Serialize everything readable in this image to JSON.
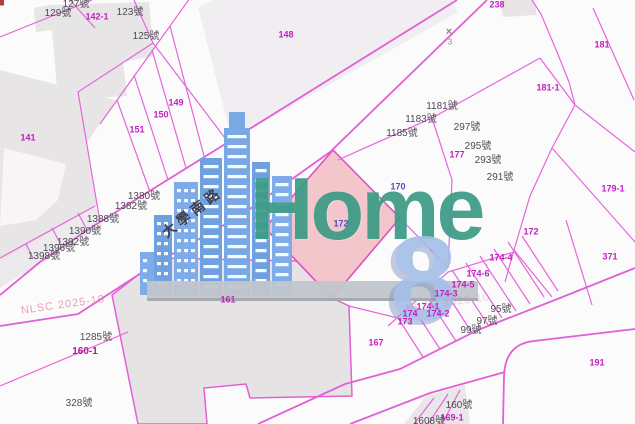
{
  "logo": {
    "wordmark": "Home",
    "number": "8"
  },
  "map": {
    "road_name": "大學南路",
    "watermark": "NLSC 2025-10",
    "control_point_number": "3",
    "control_point_symbol": "×",
    "selected_parcel": {
      "parcel_label": "172",
      "fill": "#f3c6cb"
    },
    "colors": {
      "boundary_line": "#e160d6",
      "parcel_label": "#c21ec2",
      "address_label": "#4b4b50",
      "house_number_label": "#4853c6",
      "selected_fill": "#f3c6cb",
      "building_fill": "#e8e5e7",
      "logo_building_blue": "#7aa8e4",
      "logo_wordmark_teal": "#3d9c86",
      "logo_eight_blue": "#a4bfe7"
    },
    "parcel_labels": [
      {
        "text": "142-1",
        "x": 97,
        "y": 17
      },
      {
        "text": "148",
        "x": 286,
        "y": 35
      },
      {
        "text": "238",
        "x": 497,
        "y": 5
      },
      {
        "text": "181",
        "x": 602,
        "y": 45
      },
      {
        "text": "181-1",
        "x": 548,
        "y": 88
      },
      {
        "text": "149",
        "x": 176,
        "y": 103
      },
      {
        "text": "150",
        "x": 161,
        "y": 115
      },
      {
        "text": "151",
        "x": 137,
        "y": 130
      },
      {
        "text": "141",
        "x": 28,
        "y": 138
      },
      {
        "text": "177",
        "x": 457,
        "y": 155
      },
      {
        "text": "179-1",
        "x": 613,
        "y": 189
      },
      {
        "text": "172",
        "x": 531,
        "y": 232
      },
      {
        "text": "371",
        "x": 610,
        "y": 257
      },
      {
        "text": "174-4",
        "x": 501,
        "y": 258
      },
      {
        "text": "174-6",
        "x": 478,
        "y": 274
      },
      {
        "text": "174-5",
        "x": 463,
        "y": 285
      },
      {
        "text": "174-3",
        "x": 446,
        "y": 294
      },
      {
        "text": "174-1",
        "x": 428,
        "y": 307
      },
      {
        "text": "174",
        "x": 410,
        "y": 314
      },
      {
        "text": "174-2",
        "x": 438,
        "y": 314
      },
      {
        "text": "173",
        "x": 405,
        "y": 322
      },
      {
        "text": "161",
        "x": 228,
        "y": 300
      },
      {
        "text": "167",
        "x": 376,
        "y": 343
      },
      {
        "text": "160-1",
        "x": 85,
        "y": 352
      },
      {
        "text": "191",
        "x": 597,
        "y": 363
      },
      {
        "text": "169-1",
        "x": 452,
        "y": 418
      }
    ],
    "address_labels": [
      {
        "text": "127號",
        "x": 76,
        "y": 5
      },
      {
        "text": "129號",
        "x": 58,
        "y": 14
      },
      {
        "text": "123號",
        "x": 130,
        "y": 13
      },
      {
        "text": "125號",
        "x": 146,
        "y": 37
      },
      {
        "text": "1181號",
        "x": 442,
        "y": 107
      },
      {
        "text": "1183號",
        "x": 421,
        "y": 120
      },
      {
        "text": "1185號",
        "x": 402,
        "y": 134
      },
      {
        "text": "297號",
        "x": 467,
        "y": 128
      },
      {
        "text": "295號",
        "x": 478,
        "y": 147
      },
      {
        "text": "293號",
        "x": 488,
        "y": 161
      },
      {
        "text": "291號",
        "x": 500,
        "y": 178
      },
      {
        "text": "1380號",
        "x": 144,
        "y": 197
      },
      {
        "text": "1382號",
        "x": 131,
        "y": 207
      },
      {
        "text": "1388號",
        "x": 103,
        "y": 220
      },
      {
        "text": "1390號",
        "x": 85,
        "y": 232
      },
      {
        "text": "1392號",
        "x": 73,
        "y": 243
      },
      {
        "text": "1396號",
        "x": 59,
        "y": 249
      },
      {
        "text": "1398號",
        "x": 44,
        "y": 257
      },
      {
        "text": "1285號",
        "x": 96,
        "y": 338
      },
      {
        "text": "328號",
        "x": 79,
        "y": 404
      },
      {
        "text": "95號",
        "x": 501,
        "y": 310
      },
      {
        "text": "97號",
        "x": 487,
        "y": 322
      },
      {
        "text": "99號",
        "x": 471,
        "y": 331
      },
      {
        "text": "160號",
        "x": 459,
        "y": 406
      },
      {
        "text": "1608號",
        "x": 429,
        "y": 422
      }
    ],
    "house_number_labels": [
      {
        "text": "170",
        "x": 398,
        "y": 187
      },
      {
        "text": "172",
        "x": 341,
        "y": 224
      }
    ]
  }
}
